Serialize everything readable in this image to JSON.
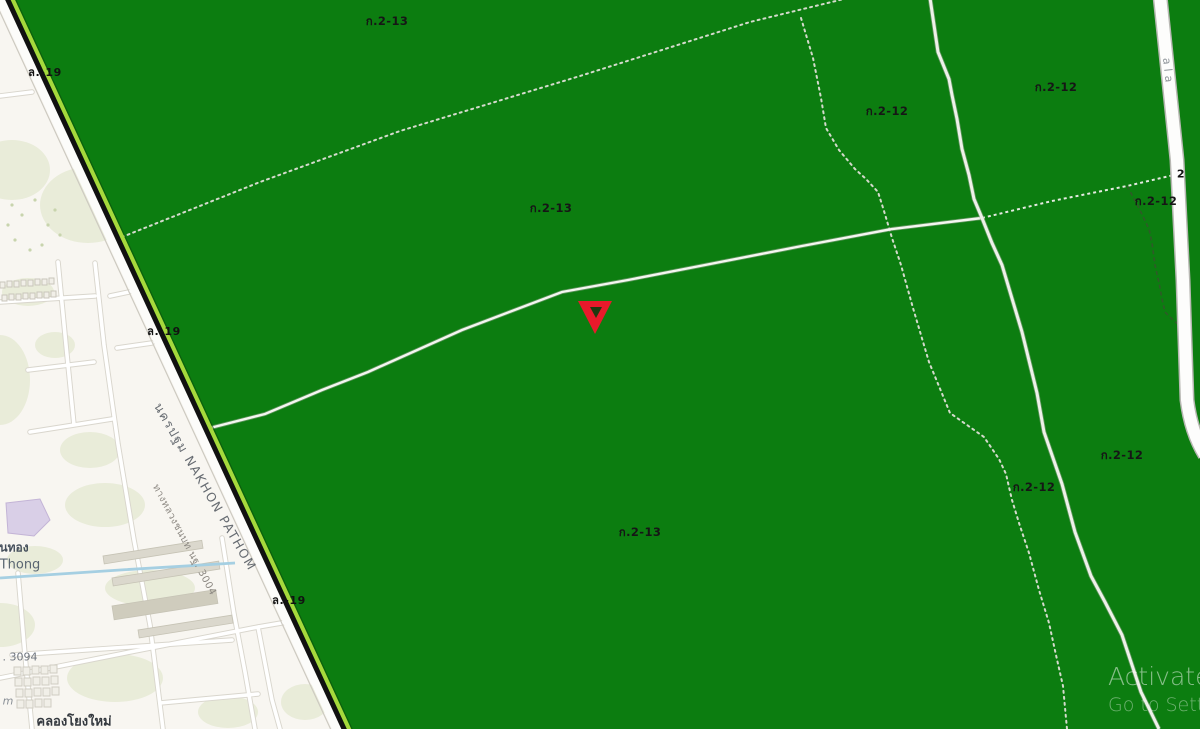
{
  "zones": {
    "labels": [
      {
        "text": "ก.2-13"
      },
      {
        "text": "ก.2-12"
      },
      {
        "text": "ก.2-12"
      },
      {
        "text": "ก.2-13"
      },
      {
        "text": "ก.2-12"
      },
      {
        "text": "ก.2-13"
      },
      {
        "text": "ก.2-12"
      },
      {
        "text": "ก.2-12"
      }
    ],
    "road_code_labels": [
      {
        "text": "ล.-19"
      },
      {
        "text": "ล.-19"
      },
      {
        "text": "ล.-19"
      }
    ],
    "small_label_2": "2"
  },
  "streets": {
    "nakhon_pathom": "นครปฐม NAKHON PATHOM",
    "rural_road": "ทางหลวงชนบท นฐ. 3004",
    "route_3094": ". 3094",
    "right_road_fragment": "ala"
  },
  "places": {
    "thong_thai": "นทอง",
    "thong_en": "Thong",
    "khlong_yong_mai": "คลองโยงใหม่",
    "m_fragment": "m"
  },
  "watermark": {
    "line1": "Activate",
    "line2": "Go to Settin"
  },
  "colors": {
    "zone_green": "#0c7d10",
    "zone_border_stripe": "#a6d93c",
    "highway_black": "#111111",
    "canal_blue": "#a5cfe2",
    "marker_red": "#e81a2b",
    "minor_road_white": "#ffffff",
    "map_background": "#f8f6f1"
  }
}
